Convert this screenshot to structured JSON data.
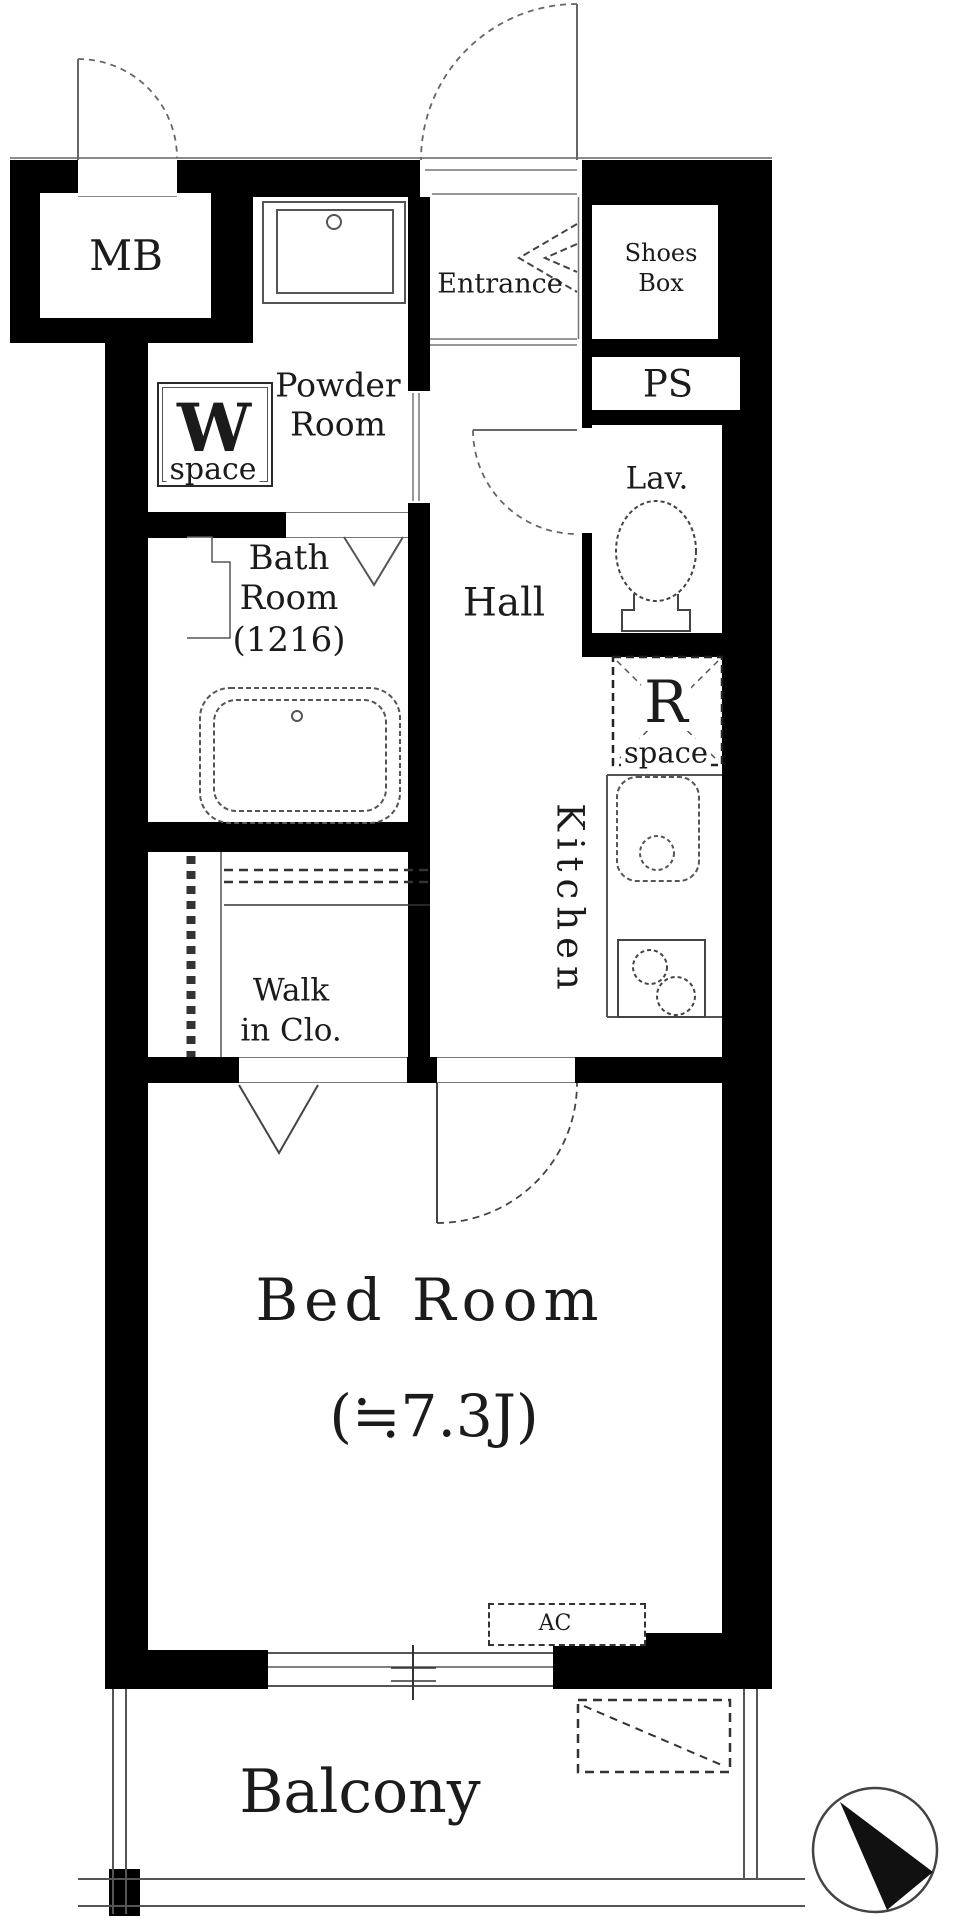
{
  "page": {
    "type": "apartment-floor-plan"
  },
  "labels": {
    "mb": "MB",
    "powder_line1": "Powder",
    "powder_line2": "Room",
    "w_initial": "W",
    "w_space": "space",
    "entrance": "Entrance",
    "shoes_line1": "Shoes",
    "shoes_line2": "Box",
    "ps": "PS",
    "lav": "Lav.",
    "hall": "Hall",
    "bath_line1": "Bath",
    "bath_line2": "Room",
    "bath_line3": "(1216)",
    "r_initial": "R",
    "r_space": "space",
    "kitchen": "Kitchen",
    "wic_line1": "Walk",
    "wic_line2": "in Clo.",
    "bedroom_line1": "Bed Room",
    "bedroom_line2": "(≒7.3J)",
    "ac": "AC",
    "balcony": "Balcony"
  },
  "colors": {
    "wall": "#000000",
    "line": "#5a5a5a",
    "text": "#1b1b1b",
    "background": "#ffffff"
  }
}
